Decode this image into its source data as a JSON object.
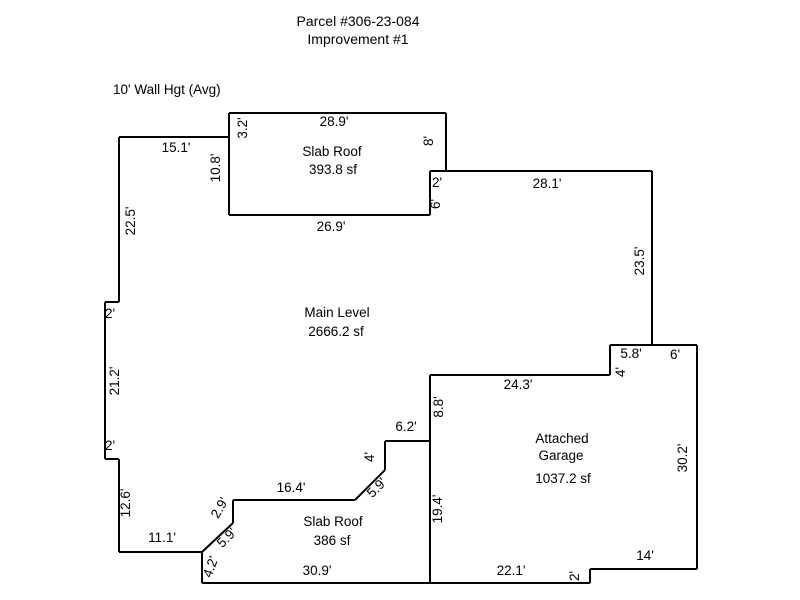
{
  "title": {
    "line1": "Parcel #306-23-084",
    "line2": "Improvement #1"
  },
  "wall_height_note": "10' Wall Hgt (Avg)",
  "colors": {
    "line": "#000000",
    "text": "#000000",
    "background": "#ffffff"
  },
  "sketch": {
    "segments": [
      [
        229,
        113,
        446,
        113
      ],
      [
        446,
        113,
        446,
        171
      ],
      [
        430,
        171,
        652,
        171
      ],
      [
        430,
        171,
        430,
        215
      ],
      [
        229,
        215,
        430,
        215
      ],
      [
        229,
        113,
        229,
        215
      ],
      [
        119,
        137,
        229,
        137
      ],
      [
        119,
        137,
        119,
        302
      ],
      [
        105,
        302,
        119,
        302
      ],
      [
        105,
        302,
        105,
        459
      ],
      [
        105,
        459,
        119,
        459
      ],
      [
        119,
        459,
        119,
        552
      ],
      [
        119,
        552,
        202,
        552
      ],
      [
        202,
        552,
        202,
        583
      ],
      [
        202,
        552,
        233,
        523
      ],
      [
        233,
        523,
        233,
        500
      ],
      [
        233,
        500,
        355,
        500
      ],
      [
        355,
        500,
        385,
        470
      ],
      [
        385,
        470,
        385,
        441
      ],
      [
        385,
        441,
        430,
        441
      ],
      [
        202,
        583,
        590,
        583
      ],
      [
        430,
        375,
        430,
        583
      ],
      [
        430,
        375,
        610,
        375
      ],
      [
        610,
        375,
        610,
        345
      ],
      [
        610,
        345,
        697,
        345
      ],
      [
        652,
        171,
        652,
        345
      ],
      [
        697,
        345,
        697,
        569
      ],
      [
        697,
        569,
        590,
        569
      ],
      [
        590,
        569,
        590,
        583
      ]
    ],
    "area_labels": [
      {
        "text": "Slab Roof",
        "x": 332,
        "y": 152,
        "r": 0
      },
      {
        "text": "393.8 sf",
        "x": 333,
        "y": 170,
        "r": 0
      },
      {
        "text": "Main Level",
        "x": 337,
        "y": 313,
        "r": 0
      },
      {
        "text": "2666.2 sf",
        "x": 336,
        "y": 332,
        "r": 0
      },
      {
        "text": "Attached",
        "x": 562,
        "y": 439,
        "r": 0
      },
      {
        "text": "Garage",
        "x": 561,
        "y": 456,
        "r": 0
      },
      {
        "text": "1037.2 sf",
        "x": 563,
        "y": 479,
        "r": 0
      },
      {
        "text": "Slab Roof",
        "x": 333,
        "y": 522,
        "r": 0
      },
      {
        "text": "386 sf",
        "x": 332,
        "y": 541,
        "r": 0
      }
    ],
    "dimension_labels": [
      {
        "text": "28.9'",
        "x": 334,
        "y": 122,
        "r": 0
      },
      {
        "text": "3.2'",
        "x": 243,
        "y": 128,
        "r": -90
      },
      {
        "text": "8'",
        "x": 429,
        "y": 141,
        "r": -90
      },
      {
        "text": "15.1'",
        "x": 176,
        "y": 148,
        "r": 0
      },
      {
        "text": "10.8'",
        "x": 216,
        "y": 168,
        "r": -90
      },
      {
        "text": "2'",
        "x": 437,
        "y": 183,
        "r": 0
      },
      {
        "text": "28.1'",
        "x": 547,
        "y": 184,
        "r": 0
      },
      {
        "text": "6'",
        "x": 436,
        "y": 204,
        "r": -90
      },
      {
        "text": "26.9'",
        "x": 331,
        "y": 227,
        "r": 0
      },
      {
        "text": "22.5'",
        "x": 131,
        "y": 221,
        "r": -90
      },
      {
        "text": "23.5'",
        "x": 640,
        "y": 261,
        "r": -90
      },
      {
        "text": "2'",
        "x": 110,
        "y": 314,
        "r": 0
      },
      {
        "text": "21.2'",
        "x": 115,
        "y": 381,
        "r": -90
      },
      {
        "text": "5.8'",
        "x": 631,
        "y": 354,
        "r": 0
      },
      {
        "text": "6'",
        "x": 675,
        "y": 355,
        "r": 0
      },
      {
        "text": "4'",
        "x": 621,
        "y": 372,
        "r": -90
      },
      {
        "text": "24.3'",
        "x": 518,
        "y": 385,
        "r": 0
      },
      {
        "text": "8.8'",
        "x": 439,
        "y": 407,
        "r": -90
      },
      {
        "text": "6.2'",
        "x": 406,
        "y": 427,
        "r": 0
      },
      {
        "text": "2'",
        "x": 110,
        "y": 446,
        "r": 0
      },
      {
        "text": "4'",
        "x": 370,
        "y": 457,
        "r": -90
      },
      {
        "text": "30.2'",
        "x": 683,
        "y": 458,
        "r": -90
      },
      {
        "text": "16.4'",
        "x": 291,
        "y": 488,
        "r": 0
      },
      {
        "text": "5.9'",
        "x": 377,
        "y": 488,
        "r": -45
      },
      {
        "text": "12.6'",
        "x": 126,
        "y": 503,
        "r": -90
      },
      {
        "text": "2.9'",
        "x": 220,
        "y": 508,
        "r": -60
      },
      {
        "text": "19.4'",
        "x": 438,
        "y": 509,
        "r": -90
      },
      {
        "text": "11.1'",
        "x": 162,
        "y": 538,
        "r": 0
      },
      {
        "text": "5.9'",
        "x": 227,
        "y": 538,
        "r": -45
      },
      {
        "text": "14'",
        "x": 645,
        "y": 556,
        "r": 0
      },
      {
        "text": "4.2'",
        "x": 211,
        "y": 567,
        "r": -70
      },
      {
        "text": "30.9'",
        "x": 317,
        "y": 571,
        "r": 0
      },
      {
        "text": "22.1'",
        "x": 511,
        "y": 571,
        "r": 0
      },
      {
        "text": "2'",
        "x": 575,
        "y": 576,
        "r": -90
      }
    ]
  }
}
